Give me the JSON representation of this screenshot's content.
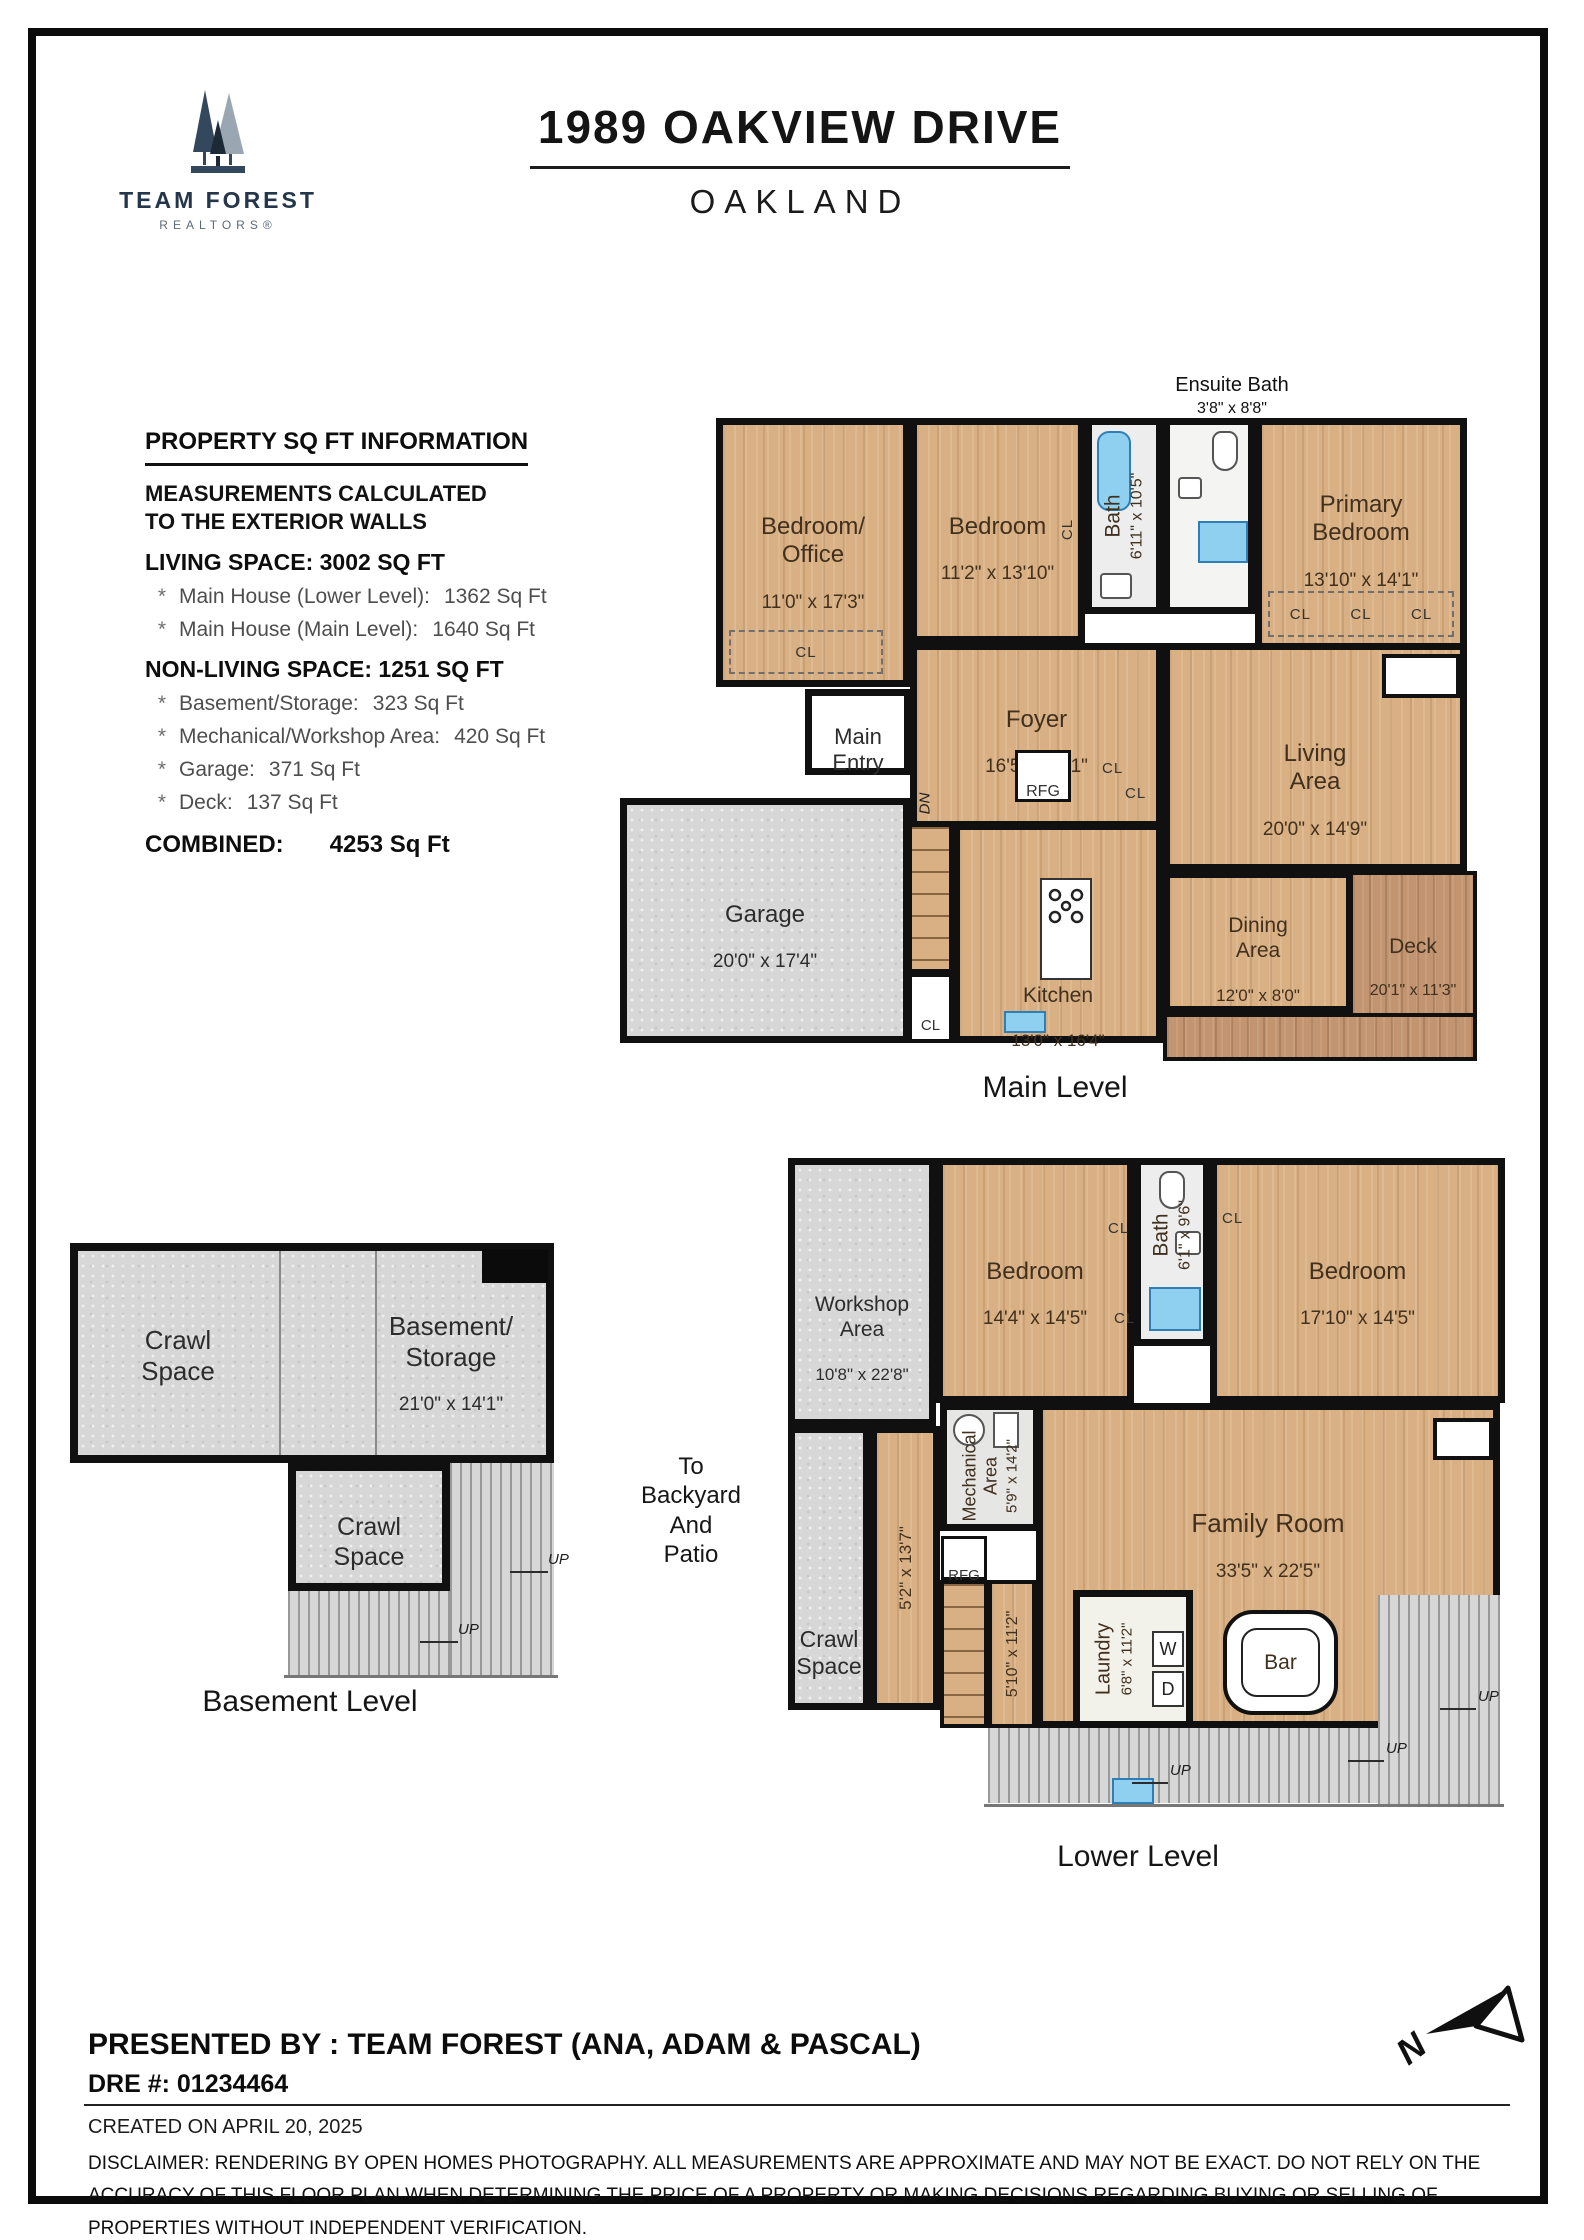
{
  "brand": {
    "team": "TEAM FOREST",
    "realtors": "REALTORS®"
  },
  "header": {
    "title": "1989 OAKVIEW DRIVE",
    "city": "OAKLAND"
  },
  "info": {
    "heading": "PROPERTY SQ FT INFORMATION",
    "note": "MEASUREMENTS CALCULATED\nTO THE EXTERIOR WALLS",
    "star": "*",
    "living_heading": "LIVING SPACE: 3002 SQ FT",
    "living_items": [
      {
        "label": "Main House (Lower Level):",
        "value": "1362 Sq Ft"
      },
      {
        "label": "Main House (Main Level):",
        "value": "1640 Sq Ft"
      }
    ],
    "nonliving_heading": "NON-LIVING SPACE: 1251 SQ FT",
    "nonliving_items": [
      {
        "label": "Basement/Storage:",
        "value": "323 Sq Ft"
      },
      {
        "label": "Mechanical/Workshop Area:",
        "value": "420 Sq Ft"
      },
      {
        "label": "Garage:",
        "value": "371 Sq Ft"
      },
      {
        "label": "Deck:",
        "value": "137 Sq Ft"
      }
    ],
    "combined_label": "COMBINED:",
    "combined_value": "4253  Sq Ft"
  },
  "main_level": {
    "caption": "Main Level",
    "ensuite_note": {
      "name": "Ensuite Bath",
      "dims": "3'8\" x 8'8\""
    },
    "bedroom_office": {
      "name": "Bedroom/\nOffice",
      "dims": "11'0\" x 17'3\""
    },
    "bedroom": {
      "name": "Bedroom",
      "dims": "11'2\" x 13'10\""
    },
    "bath": {
      "name": "Bath",
      "dims": "6'11\" x 10'5\""
    },
    "primary_bedroom": {
      "name": "Primary\nBedroom",
      "dims": "13'10\" x 14'1\""
    },
    "foyer": {
      "name": "Foyer",
      "dims": "16'5\" x 9'11\""
    },
    "main_entry": "Main\nEntry",
    "living": {
      "name": "Living\nArea",
      "dims": "20'0\" x 14'9\""
    },
    "dining": {
      "name": "Dining\nArea",
      "dims": "12'0\" x 8'0\""
    },
    "deck": {
      "name": "Deck",
      "dims": "20'1\" x 11'3\""
    },
    "garage": {
      "name": "Garage",
      "dims": "20'0\" x 17'4\""
    },
    "kitchen": {
      "name": "Kitchen",
      "dims": "13'0\" x 16'4\""
    },
    "rfg": "RFG",
    "dn": "DN"
  },
  "basement": {
    "caption": "Basement Level",
    "crawl1": "Crawl\nSpace",
    "storage": {
      "name": "Basement/\nStorage",
      "dims": "21'0\" x 14'1\""
    },
    "crawl2": "Crawl\nSpace",
    "backyard_note": "To\nBackyard\nAnd\nPatio"
  },
  "lower_level": {
    "caption": "Lower Level",
    "workshop": {
      "name": "Workshop\nArea",
      "dims": "10'8\" x 22'8\""
    },
    "bedroom_a": {
      "name": "Bedroom",
      "dims": "14'4\" x 14'5\""
    },
    "bath": {
      "name": "Bath",
      "dims": "6'1\" x 9'6\""
    },
    "bedroom_b": {
      "name": "Bedroom",
      "dims": "17'10\" x 14'5\""
    },
    "mechanical": {
      "name": "Mechanical\nArea",
      "dims": "5'9\" x 14'2\""
    },
    "family": {
      "name": "Family Room",
      "dims": "33'5\" x 22'5\""
    },
    "crawl": "Crawl\nSpace",
    "corridor_dims": "5'2\" x 13'7\"",
    "stair_dims": "5'10\" x 11'2\"",
    "laundry": {
      "name": "Laundry",
      "dims": "6'8\" x 11'2\""
    },
    "washer": "W",
    "dryer": "D",
    "bar": "Bar",
    "rfg": "RFG"
  },
  "labels": {
    "cl": "CL",
    "up": "UP"
  },
  "footer": {
    "presented": "PRESENTED BY : TEAM FOREST (ANA, ADAM & PASCAL)",
    "dre": "DRE #: 01234464",
    "created": "CREATED ON APRIL 20, 2025",
    "disclaimer": "DISCLAIMER: RENDERING BY OPEN HOMES PHOTOGRAPHY. ALL MEASUREMENTS ARE APPROXIMATE AND MAY NOT BE EXACT. DO NOT RELY ON THE ACCURACY OF THIS FLOOR PLAN WHEN DETERMINING THE PRICE OF A PROPERTY OR MAKING DECISIONS REGARDING BUYING OR SELLING OF PROPERTIES WITHOUT INDEPENDENT VERIFICATION."
  },
  "colors": {
    "wood": "#d9b083",
    "deck_wood": "#c2946f",
    "concrete": "#d7d7d7",
    "fixture_blue": "#8fd0f0",
    "wall": "#101010",
    "brand_navy": "#24374a"
  }
}
